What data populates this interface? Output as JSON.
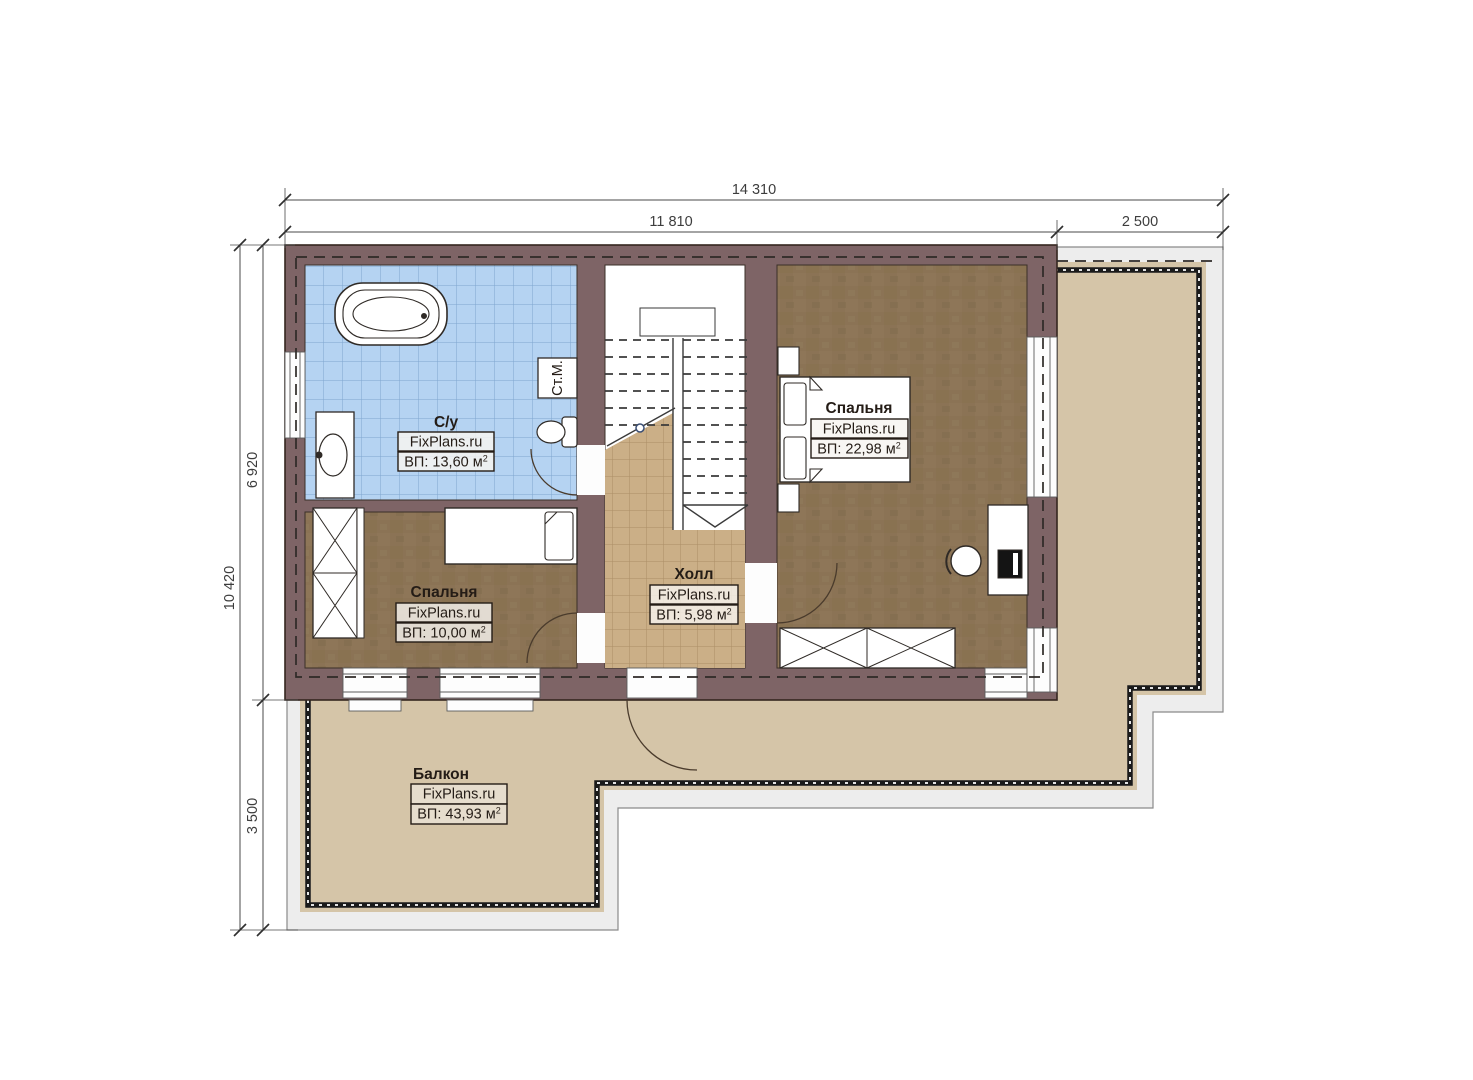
{
  "plan_title": "floor-plan-mansard-level",
  "dimensions": {
    "top": {
      "overall": "14 310",
      "left_segment": "11 810",
      "right_segment": "2 500"
    },
    "left": {
      "overall": "10 420",
      "top_segment": "6 920",
      "bottom_segment": "3 500"
    }
  },
  "rooms": {
    "bathroom": {
      "name": "С/у",
      "brand": "FixPlans.ru",
      "area": "ВП: 13,60 м",
      "sup": "2"
    },
    "bedroom_left": {
      "name": "Спальня",
      "brand": "FixPlans.ru",
      "area": "ВП: 10,00 м",
      "sup": "2"
    },
    "bedroom_right": {
      "name": "Спальня",
      "brand": "FixPlans.ru",
      "area": "ВП: 22,98 м",
      "sup": "2"
    },
    "hall": {
      "name": "Холл",
      "brand": "FixPlans.ru",
      "area": "ВП: 5,98 м",
      "sup": "2"
    },
    "balcony": {
      "name": "Балкон",
      "brand": "FixPlans.ru",
      "area": "ВП: 43,93 м",
      "sup": "2"
    }
  },
  "fixtures": {
    "washing_machine": "Ст.М."
  },
  "colors": {
    "wall": "#7e6466",
    "wall_outline": "#35261f",
    "bathroom_floor": "#b5d3f2",
    "bathroom_grid": "#7fa6cf",
    "bedroom_floor": "#8b7355",
    "hall_floor": "#cbaf87",
    "balcony_floor": "#d5c5a8",
    "outer_band": "#ededed",
    "railing": "#1a1a1a"
  }
}
